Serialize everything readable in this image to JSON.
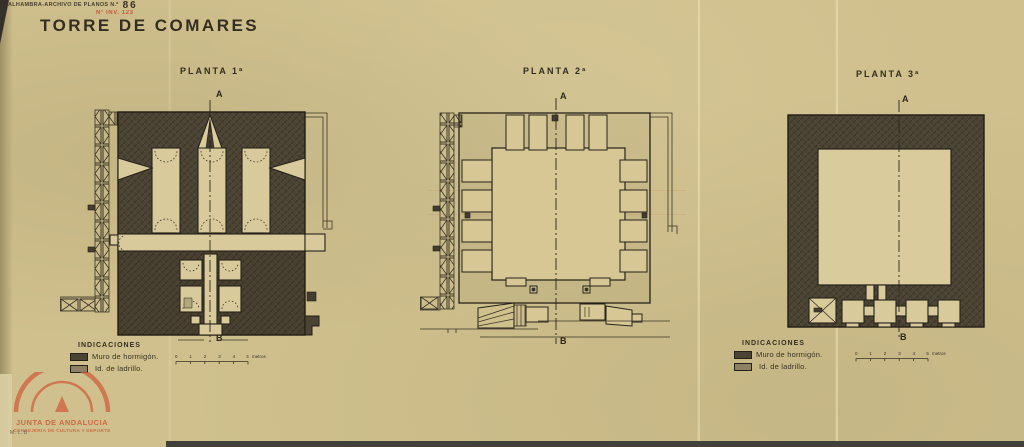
{
  "page": {
    "archive_label": "ALHAMBRA-ARCHIVO DE PLANOS N.º",
    "archive_number": "86",
    "inventory_stamp": "Nº INV. 123",
    "title": "TORRE DE COMARES",
    "pencil_note": "M.L.B"
  },
  "plans": [
    {
      "label": "PLANTA 1ª",
      "axis_top": "A",
      "axis_bottom": "B"
    },
    {
      "label": "PLANTA 2ª",
      "axis_top": "A",
      "axis_bottom": "B"
    },
    {
      "label": "PLANTA 3ª",
      "axis_top": "A",
      "axis_bottom": "B"
    }
  ],
  "legend": {
    "header": "INDICACIONES",
    "items": [
      {
        "swatch": "concrete-dark",
        "label": "Muro de hormigón."
      },
      {
        "swatch": "brick-light",
        "label": "Id. de ladrillo."
      }
    ]
  },
  "scale_bar": {
    "ticks": [
      "0",
      "1",
      "2",
      "3",
      "4",
      "5"
    ],
    "unit": "metros"
  },
  "stamp": {
    "org": "JUNTA DE ANDALUCIA",
    "dept": "CONSEJERIA DE CULTURA Y DEPORTE"
  },
  "colors": {
    "paper": "#cfc08d",
    "ink": "#2b261d",
    "wall_concrete": "#4b4434",
    "wall_brick": "#8d8063",
    "stamp_red": "#cf5f3c"
  }
}
